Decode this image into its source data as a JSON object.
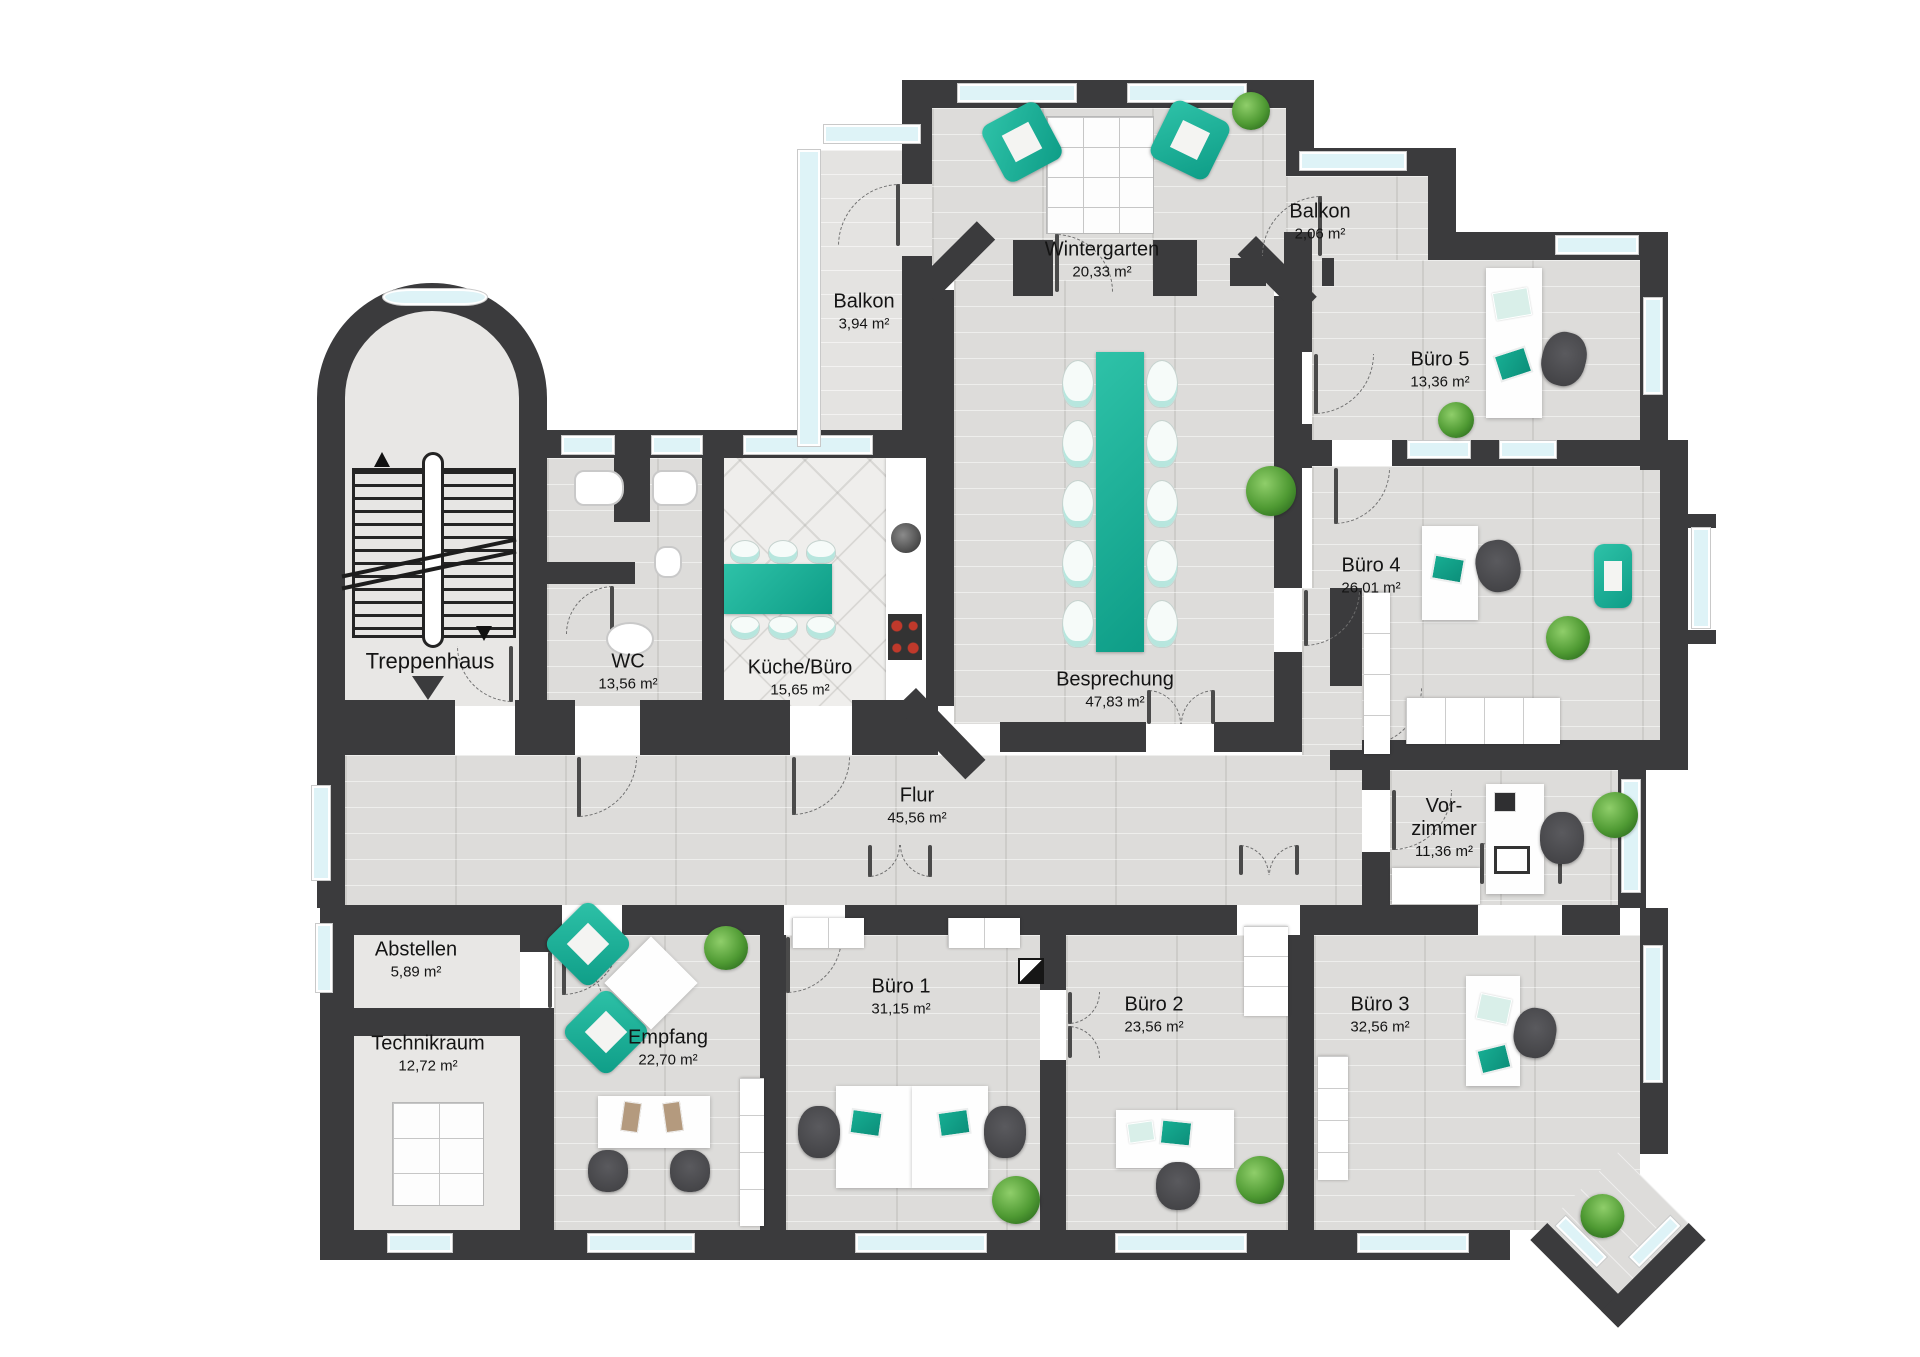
{
  "floorplan": {
    "rooms": {
      "treppenhaus": {
        "name": "Treppenhaus"
      },
      "wc": {
        "name": "WC",
        "area": "13,56 m²"
      },
      "kueche": {
        "name": "Küche/Büro",
        "area": "15,65 m²"
      },
      "besprechung": {
        "name": "Besprechung",
        "area": "47,83 m²"
      },
      "wintergarten": {
        "name": "Wintergarten",
        "area": "20,33 m²"
      },
      "balkon_links": {
        "name": "Balkon",
        "area": "3,94 m²"
      },
      "balkon_rechts": {
        "name": "Balkon",
        "area": "2,06 m²"
      },
      "buero1": {
        "name": "Büro 1",
        "area": "31,15 m²"
      },
      "buero2": {
        "name": "Büro 2",
        "area": "23,56 m²"
      },
      "buero3": {
        "name": "Büro 3",
        "area": "32,56 m²"
      },
      "buero4": {
        "name": "Büro 4",
        "area": "26,01 m²"
      },
      "buero5": {
        "name": "Büro 5",
        "area": "13,36 m²"
      },
      "flur": {
        "name": "Flur",
        "area": "45,56 m²"
      },
      "vorzimmer": {
        "name_line1": "Vor-",
        "name_line2": "zimmer",
        "area": "11,36 m²"
      },
      "abstellen": {
        "name": "Abstellen",
        "area": "5,89 m²"
      },
      "technikraum": {
        "name": "Technikraum",
        "area": "12,72 m²"
      },
      "empfang": {
        "name": "Empfang",
        "area": "22,70 m²"
      }
    },
    "colors": {
      "wall": "#3b3b3d",
      "accent": "#17b199",
      "window": "#def3f7",
      "floor": "#dddcda"
    }
  }
}
